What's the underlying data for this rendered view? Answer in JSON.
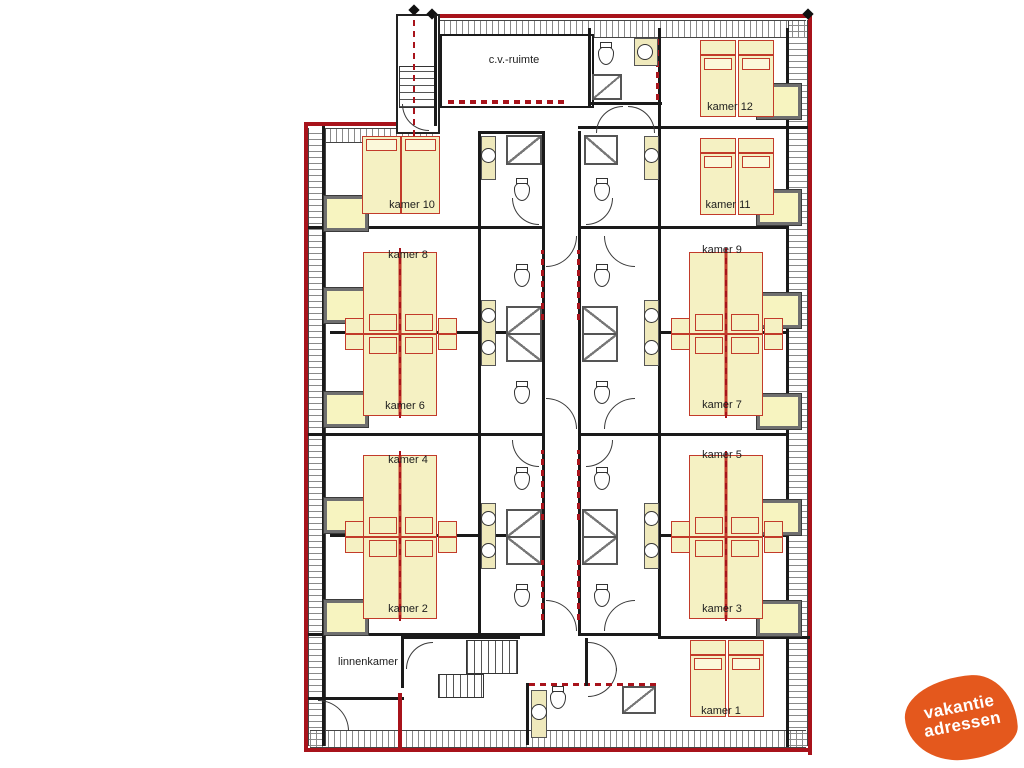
{
  "type": "floorplan",
  "rooms": {
    "cv": {
      "label": "c.v.-ruimte"
    },
    "k12": {
      "label": "kamer 12"
    },
    "k11": {
      "label": "kamer 11"
    },
    "k10": {
      "label": "kamer 10"
    },
    "k9": {
      "label": "kamer 9"
    },
    "k8": {
      "label": "kamer 8"
    },
    "k7": {
      "label": "kamer 7"
    },
    "k6": {
      "label": "kamer 6"
    },
    "k5": {
      "label": "kamer 5"
    },
    "k4": {
      "label": "kamer 4"
    },
    "k3": {
      "label": "kamer 3"
    },
    "k2": {
      "label": "kamer 2"
    },
    "k1": {
      "label": "kamer 1"
    },
    "linnen": {
      "label": "linnenkamer"
    }
  },
  "logo": {
    "word1": "vakantie",
    "word2": "adressen",
    "color": "#e4581d"
  },
  "palette": {
    "outline_red": "#a8131b",
    "wall_black": "#1a1a1a",
    "furniture_fill": "#f5f1c3",
    "furniture_stroke": "#c23b2a",
    "window_fill": "#f7f4c0",
    "window_frame": "#6f6f6f",
    "hatch_gray": "#8a8a8a"
  }
}
